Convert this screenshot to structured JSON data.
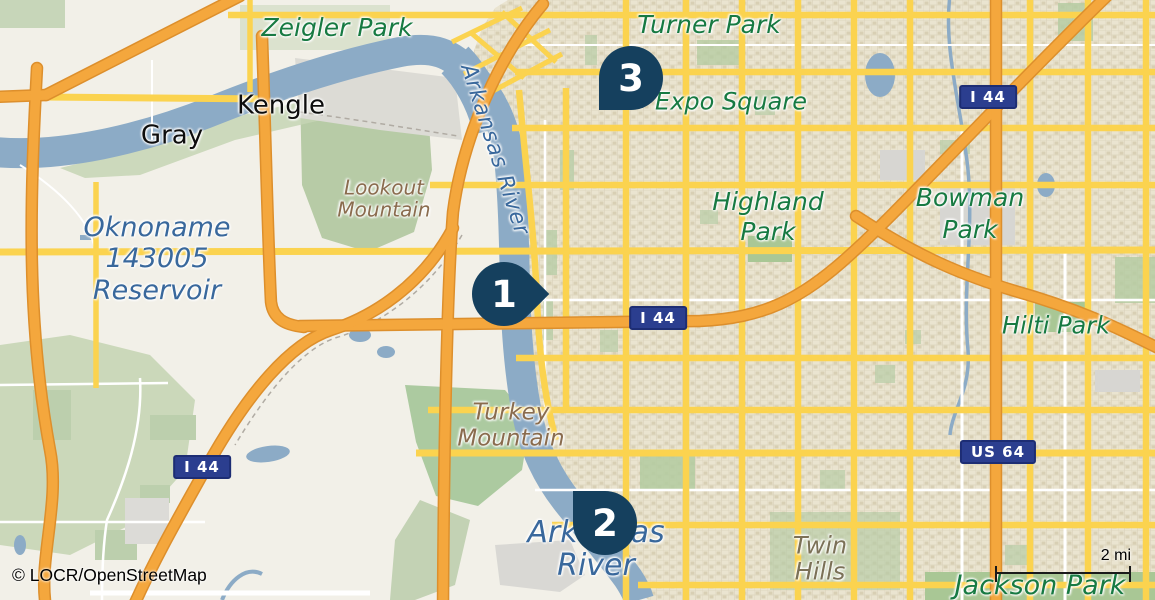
{
  "attribution": "© LOCR/OpenStreetMap",
  "scale": {
    "label": "2 mi"
  },
  "markers": [
    {
      "number": "1"
    },
    {
      "number": "2"
    },
    {
      "number": "3"
    }
  ],
  "shields": [
    {
      "label": "I 44"
    },
    {
      "label": "I 44"
    },
    {
      "label": "I 44"
    },
    {
      "label": "US 64"
    }
  ],
  "labels": {
    "zeigler_park": {
      "lines": [
        "Zeigler Park"
      ]
    },
    "turner_park": {
      "lines": [
        "Turner Park"
      ]
    },
    "expo_square": {
      "lines": [
        "Expo Square"
      ]
    },
    "kengle": {
      "lines": [
        "Kengle"
      ]
    },
    "gray": {
      "lines": [
        "Gray"
      ]
    },
    "lookout_mountain": {
      "lines": [
        "Lookout",
        "Mountain"
      ]
    },
    "oknoname_reservoir": {
      "lines": [
        "Oknoname",
        "143005",
        "Reservoir"
      ]
    },
    "arkansas_river_north": {
      "lines": [
        "Arkansas River"
      ]
    },
    "highland_park": {
      "lines": [
        "Highland",
        "Park"
      ]
    },
    "bowman_park": {
      "lines": [
        "Bowman",
        "Park"
      ]
    },
    "hilti_park": {
      "lines": [
        "Hilti Park"
      ]
    },
    "turkey_mountain": {
      "lines": [
        "Turkey",
        "Mountain"
      ]
    },
    "arkansas_river_south": {
      "lines": [
        "Arkansas",
        "River"
      ]
    },
    "twin_hills": {
      "lines": [
        "Twin",
        "Hills"
      ]
    },
    "jackson_park": {
      "lines": [
        "Jackson Park"
      ]
    }
  },
  "colors": {
    "marker": "#15405e",
    "shield_bg": "#2b3e8f",
    "shield_text": "#ffffff",
    "motorway": "#f4a73d",
    "secondary_road": "#fbd34f",
    "water": "#8cabc6",
    "park_fill": "#a9c795",
    "park_label": "#177a42",
    "water_label": "#39689c",
    "terrain_label": "#8a6c4e",
    "city_label": "#0d0d0d"
  }
}
